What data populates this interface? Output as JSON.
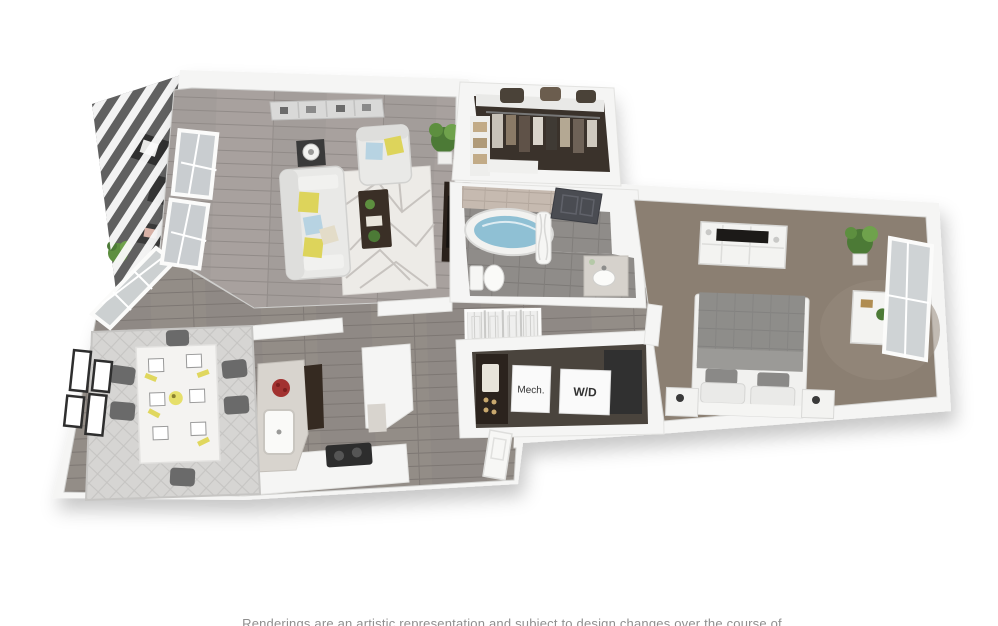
{
  "labels": {
    "mech": "Mech.",
    "washer_dryer": "W/D"
  },
  "disclaimer": "Renderings are an artistic representation and subject to design changes over the course of time.",
  "palette": {
    "background": "#ffffff",
    "walls": "#f5f5f4",
    "wood_living": "#a39d9a",
    "wood_kitchen_hall": "#8f8985",
    "carpet_bedroom": "#8b7f72",
    "closet_floor": "#3a322b",
    "bath_tile_floor": "#8f8c89",
    "bath_wall_tile": "#c6bab0",
    "tub_water": "#8fc0d4",
    "living_rug": "#edebe7",
    "dining_rug": "#d6d5d3",
    "balcony_floor": "#606060",
    "accent_pillow_yellow": "#ddd45b",
    "accent_pillow_blue": "#b7d3e2",
    "fruit_bowl_red": "#a23230",
    "dark_wood_furniture": "#3a2f26",
    "label_text": "#333333"
  },
  "rooms": [
    "living-room",
    "dining-area",
    "kitchen",
    "hallway",
    "walk-in-closet",
    "bathroom",
    "bedroom",
    "mechanical-room",
    "washer-dryer-closet",
    "balcony"
  ]
}
